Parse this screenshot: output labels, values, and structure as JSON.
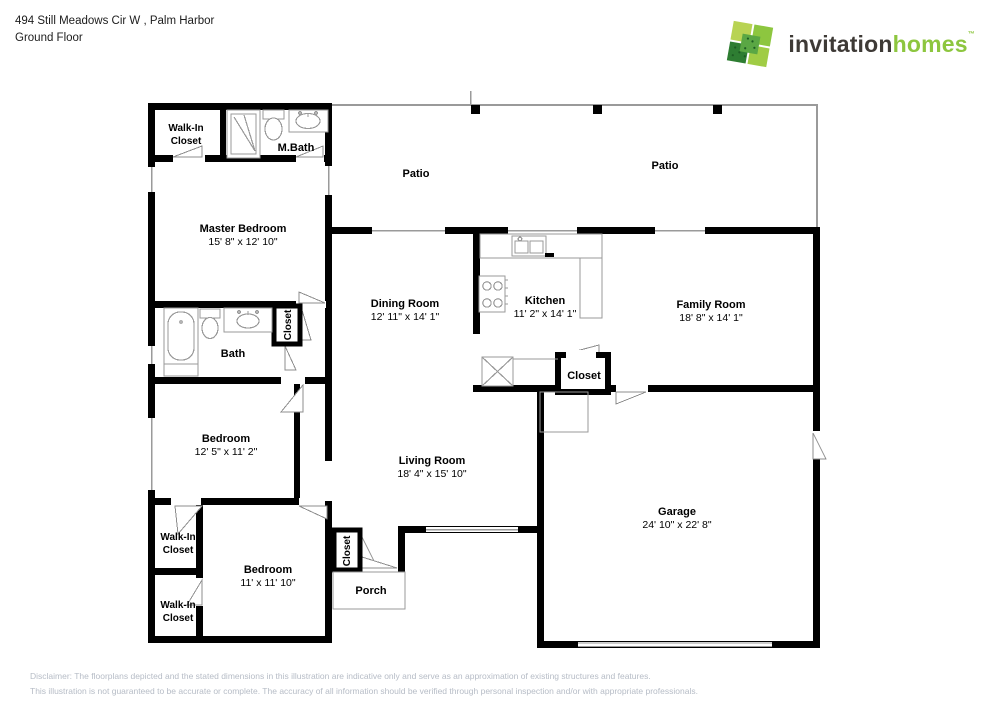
{
  "header": {
    "address": "494 Still Meadows Cir W , Palm Harbor",
    "floor": "Ground Floor"
  },
  "logo": {
    "brand_primary": "invitation",
    "brand_secondary": "homes",
    "trademark": "™",
    "colors": {
      "primary_text": "#3e3a36",
      "secondary_text": "#8dc63f",
      "mark_greens": [
        "#b8d353",
        "#8dc63f",
        "#5aa744",
        "#2e7d32",
        "#a0cc45"
      ]
    }
  },
  "plan": {
    "wall_color": "#000000",
    "thin_line_color": "#9a9a9a",
    "rooms": {
      "wic_master": {
        "line1": "Walk-In",
        "line2": "Closet"
      },
      "m_bath": {
        "name": "M.Bath"
      },
      "master_bedroom": {
        "name": "Master Bedroom",
        "dims": "15' 8\" x 12' 10\""
      },
      "patio_left": {
        "name": "Patio"
      },
      "patio_right": {
        "name": "Patio"
      },
      "dining_room": {
        "name": "Dining Room",
        "dims": "12' 11\" x 14' 1\""
      },
      "kitchen": {
        "name": "Kitchen",
        "dims": "11' 2\" x 14' 1\""
      },
      "family_room": {
        "name": "Family Room",
        "dims": "18' 8\" x 14' 1\""
      },
      "bath": {
        "name": "Bath"
      },
      "bath_closet": {
        "name": "Closet"
      },
      "bedroom_1": {
        "name": "Bedroom",
        "dims": "12' 5\" x 11' 2\""
      },
      "living_room": {
        "name": "Living Room",
        "dims": "18' 4\" x 15' 10\""
      },
      "hall_closet": {
        "name": "Closet"
      },
      "garage": {
        "name": "Garage",
        "dims": "24' 10\" x 22' 8\""
      },
      "wic_1": {
        "line1": "Walk-In",
        "line2": "Closet"
      },
      "bedroom_2": {
        "name": "Bedroom",
        "dims": "11' x 11' 10\""
      },
      "wic_2": {
        "line1": "Walk-In",
        "line2": "Closet"
      },
      "entry_closet": {
        "name": "Closet"
      },
      "porch": {
        "name": "Porch"
      }
    }
  },
  "disclaimer": {
    "line1": "Disclaimer: The floorplans depicted and the stated dimensions in this illustration are indicative only and serve as an approximation of existing structures and features.",
    "line2": "This illustration is not guaranteed to be accurate or complete. The accuracy of all information should be verified through personal inspection and/or with appropriate professionals."
  }
}
